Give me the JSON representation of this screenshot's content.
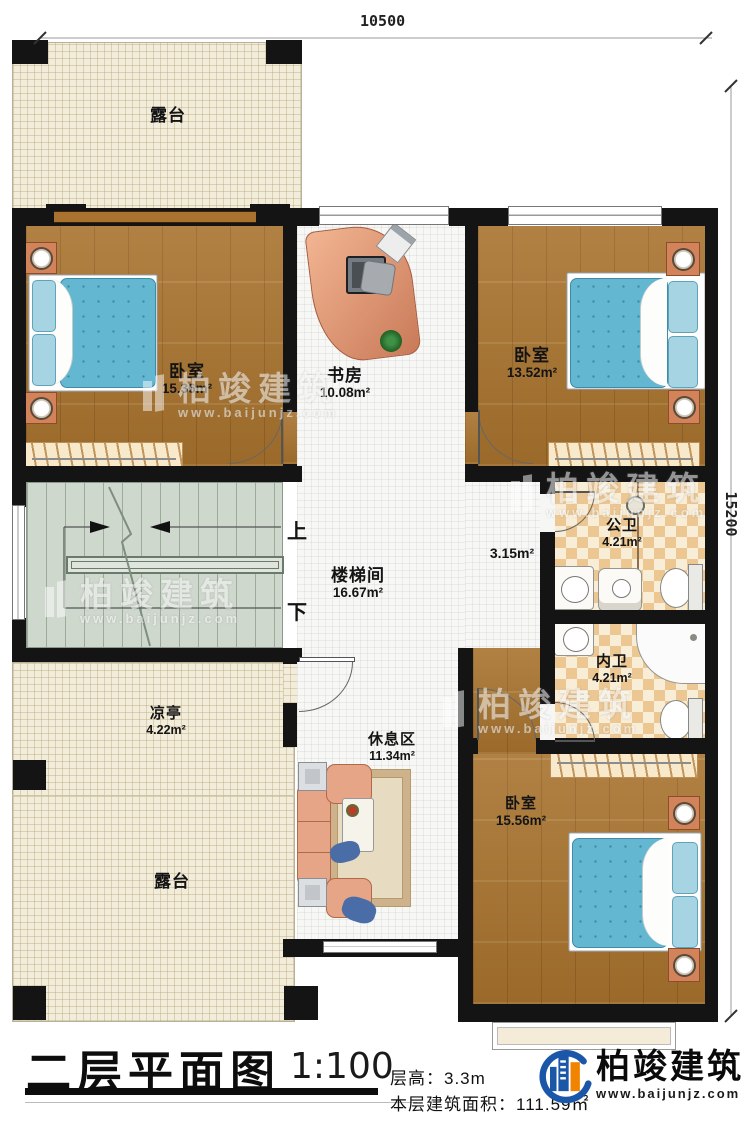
{
  "dimensions": {
    "top": "10500",
    "right": "15200"
  },
  "stairs": {
    "up": "上",
    "down": "下"
  },
  "rooms": {
    "terrace_top": {
      "name": "露台"
    },
    "bedroom_tl": {
      "name": "卧室",
      "area": "15.36m²"
    },
    "study": {
      "name": "书房",
      "area": "10.08m²"
    },
    "bedroom_tr": {
      "name": "卧室",
      "area": "13.52m²"
    },
    "stairwell": {
      "name": "楼梯间",
      "area": "16.67m²"
    },
    "corridor": {
      "area": "3.15m²"
    },
    "public_bath": {
      "name": "公卫",
      "area": "4.21m²"
    },
    "private_bath": {
      "name": "内卫",
      "area": "4.21m²"
    },
    "pavilion": {
      "name": "凉亭",
      "area": "4.22m²"
    },
    "rest_area": {
      "name": "休息区",
      "area": "11.34m²"
    },
    "bedroom_b": {
      "name": "卧室",
      "area": "15.56m²"
    },
    "terrace_bottom": {
      "name": "露台"
    }
  },
  "titleblock": {
    "title": "二层平面图",
    "scale": "1:100",
    "floor_height": "层高：3.3m",
    "floor_area": "本层建筑面积：111.59㎡"
  },
  "brand": {
    "name": "柏竣建筑",
    "url": "www.baijunjz.com"
  },
  "watermark": {
    "name": "柏竣建筑",
    "url": "www.baijunjz.com"
  },
  "colors": {
    "wall": "#141414",
    "wood_floor": "#a8732e",
    "bed": "#64b7d1",
    "bath_tile": "#ecc792",
    "terrace": "#f2ecda",
    "brand_blue": "#1b57a8",
    "brand_orange": "#f08300"
  }
}
